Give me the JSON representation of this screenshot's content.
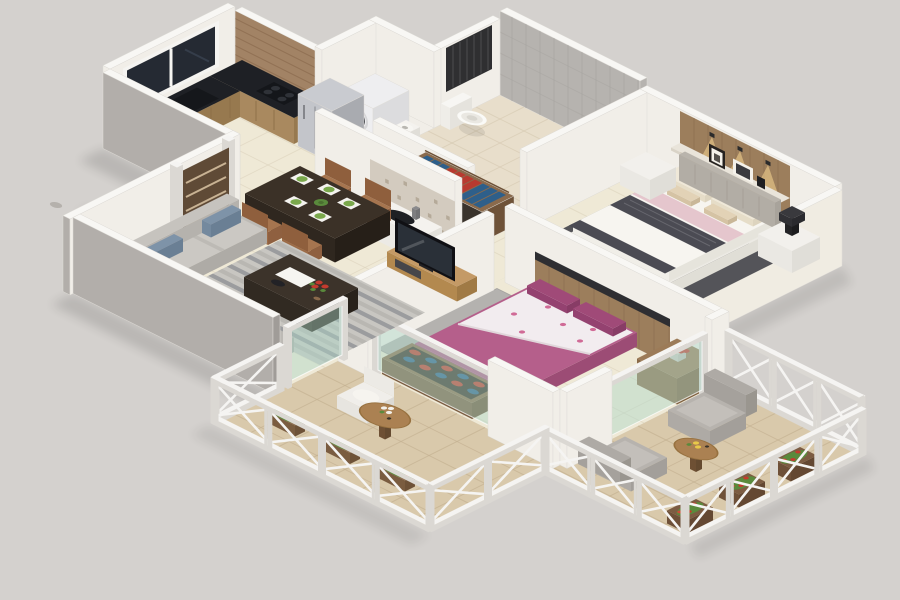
{
  "scene": {
    "type": "3d-isometric-floor-plan-render",
    "description": "3D isometric cutaway render of a furnished two-bedroom apartment floor plan on a plain gray background, with kitchen, dining area, living room, master bedroom with attached bathroom, second bedroom, wash area, entrance door and two balconies with white lattice railings.",
    "background_color": "#d4d1ce",
    "visible_text": ""
  },
  "rooms": [
    {
      "id": "kitchen",
      "name": "Kitchen",
      "furniture": [
        "L-shaped black granite counter",
        "gas hob",
        "sink",
        "refrigerator",
        "fruit bowls",
        "window",
        "wood-strip tiled wall"
      ]
    },
    {
      "id": "utility-niche",
      "name": "Utility Niche",
      "furniture": [
        "front-load washing machine"
      ]
    },
    {
      "id": "bathroom",
      "name": "Bathroom",
      "furniture": [
        "wall-hung toilet",
        "wash basin",
        "shower fixture",
        "dark ventilation grille",
        "gray tiled walls"
      ]
    },
    {
      "id": "master-bedroom",
      "name": "Master Bedroom",
      "furniture": [
        "double bed with dark patterned runner and pink throw",
        "wooden headboard panel with 3 spotlights",
        "shelf with picture frames",
        "two nightstands",
        "black table lamp",
        "dark floor mat"
      ]
    },
    {
      "id": "corridor",
      "name": "Dressing Corridor",
      "furniture": [
        "open wardrobe with blue and red clothes"
      ]
    },
    {
      "id": "wash-area",
      "name": "Wash Area",
      "furniture": [
        "mosaic tiled wall",
        "white counter with basin"
      ]
    },
    {
      "id": "dining",
      "name": "Dining Area",
      "furniture": [
        "dark rectangular dining table",
        "four brown chairs",
        "four place settings with green plates"
      ]
    },
    {
      "id": "living-room",
      "name": "Living Room",
      "furniture": [
        "L-shaped gray sofa with blue lumbar cushions",
        "striped gray rug",
        "dark coffee table with red flowers and tray",
        "wooden TV unit",
        "flat-screen TV"
      ]
    },
    {
      "id": "bedroom-2",
      "name": "Bedroom 2",
      "furniture": [
        "double bed with magenta duvet and floral sheet",
        "wooden headboard with dark ledge",
        "side cabinet with red flower vase",
        "gray rug",
        "open shoe rack with red and blue shoes",
        "glass partitions"
      ]
    },
    {
      "id": "balcony-front",
      "name": "Front Balcony",
      "furniture": [
        "round wooden table",
        "white chair",
        "hanging flower planters",
        "white X-lattice railing"
      ]
    },
    {
      "id": "balcony-right",
      "name": "Right Balcony",
      "furniture": [
        "two gray armchairs",
        "round wooden table with yellow flowers",
        "flower planter boxes",
        "white X-lattice railing and trellis wall"
      ]
    },
    {
      "id": "entrance",
      "name": "Entrance",
      "furniture": [
        "brown panelled door",
        "gray tiled landing"
      ]
    }
  ],
  "colors": {
    "bg": "#d4d1ce",
    "wallTop": "#f8f7f4",
    "wallEdge": "#dedbd6",
    "wallFace": "#f1eee8",
    "wallLit": "#f0ece2",
    "wallOuter": "#b2aeaa",
    "wallOuterDark": "#a09c98",
    "bathTileWall": "#b6b3af",
    "bathTileLine": "#a7a4a0",
    "grille": "#2f2f31",
    "grilleSlat": "#47474a",
    "floorCream": "#efe9d6",
    "floorLine": "#ddd4be",
    "bathFloor": "#e8decb",
    "bathFloorLine": "#d6cab2",
    "balconyFloor": "#d9c9ab",
    "balconyLine": "#c3b090",
    "landing": "#cbc5be",
    "landingLine": "#b3ada5",
    "woodWall": "#a28365",
    "woodWallLine": "#86684c",
    "windowDark": "#252a33",
    "frameWhite": "#f5f4f1",
    "granite": "#1e2025",
    "cabinetWood": "#a9895f",
    "cabinetLine": "#8a6c46",
    "cabinetSide": "#97794f",
    "fridgeTop": "#c9cbd0",
    "fridgeFront": "#c3c5ca",
    "fridgeSide": "#a9abb0",
    "fridgeSeam": "#9b9da2",
    "washer": "#eeeef0",
    "washerSide": "#dcdcde",
    "washerDoor": "#2c3036",
    "washerDoorIn": "#4a5058",
    "doorBrown": "#5f4a36",
    "doorStripe": "#c9b394",
    "headboardWood": "#9c7e5c",
    "plankLine": "#85684b",
    "glow": "rgba(255,222,150,0.5)",
    "shelf": "#e9e4da",
    "shelfFront": "#d9d3c7",
    "frameDark": "#262220",
    "frameLight": "#f4f1ea",
    "frameInner": "#3a3a3e",
    "headboardGray": "#b9b4ac",
    "bedWhite": "#f7f5f0",
    "bedSide": "#eceae4",
    "runnerDark": "#4b4b53",
    "bedPink": "#e5c6cd",
    "pillowCream": "#efe8d8",
    "pillowTan": "#e2d2b6",
    "matDark": "#46474d",
    "nightstand": "#f2f0ec",
    "nightstandSide": "#e0ded8",
    "lampDark": "#2b2b2d",
    "mosaic": "#d3cbbf",
    "mosaicDot": "#b5aa99",
    "counterWhite": "#f4f2ee",
    "sinkDark": "#1e2024",
    "tableDark": "#3b3127",
    "tableSide": "#2f271f",
    "tableSide2": "#261f18",
    "chairBrown": "#a6754f",
    "chairBack": "#8f5f3d",
    "placemat": "#f4f3ef",
    "plateGreen": "#7aa84c",
    "rugBase": "#c8c6c1",
    "rugStripeA": "#9b9c9e",
    "rugStripeB": "#b9b7b2",
    "coffeeTable": "#3c332a",
    "tray": "#f6f5f1",
    "flowerRed": "#c43b2e",
    "leafGreen": "#5a8a3c",
    "flowerYellow": "#e8c84a",
    "sofaBack": "#c6c3be",
    "sofaSide": "#b5b2ad",
    "sofaSeat": "#bdbab5",
    "sofaCushion": "#cbc8c3",
    "lumbarBlue": "#7e93a8",
    "lumbarSide": "#6a7f94",
    "tvCab": "#c49a66",
    "tvCabSide": "#a07a45",
    "tvDark": "#101014",
    "tvScreen": "#2a3038",
    "drawerDark": "#46464a",
    "br2Magenta": "#b55f8b",
    "br2Side": "#a8537f",
    "br2Side2": "#9c4c75",
    "br2Floral": "#f2ecef",
    "br2Dot": "#d06a96",
    "br2Pillow": "#a04a78",
    "br2Rug": "#b4b2af",
    "ledgeDark": "#2e2e32",
    "cabWood": "#9c7b58",
    "cabWoodSide": "#7e6040",
    "shoeBox": "#8a6a4c",
    "shoeBoxSide": "#6e5238",
    "shoeBoxIn": "#3a3128",
    "shoeRed": "#c0392b",
    "shoeBlue": "#2e5f8a",
    "clothesRed": "#b83a30",
    "clothesBlue": "#2e5f8a",
    "railWhite": "#f5f4f2",
    "railShade": "#dbd8d3",
    "glassGreen": "rgba(174,215,200,0.45)",
    "glassEdge": "rgba(255,255,255,0.75)",
    "roundTable": "#ab8152",
    "roundTableRim": "#97713f",
    "tableLeg": "#7e5e40",
    "tableLegSide": "#644a30",
    "armchair": "#b7b3ae",
    "armchairSide": "#a39f9a",
    "armchairBack": "#aeaaa5",
    "armchairCushion": "#c3bfba",
    "chairWhite": "#f0eeea",
    "chairWhiteSide": "#dcdad5",
    "toilet": "#fafaf7",
    "toiletRing": "#eae8e2",
    "planter": "#7c5c42",
    "planterSide": "#644832",
    "shadow": "#000000",
    "lightPool": "rgba(255,238,195,0.22)"
  }
}
